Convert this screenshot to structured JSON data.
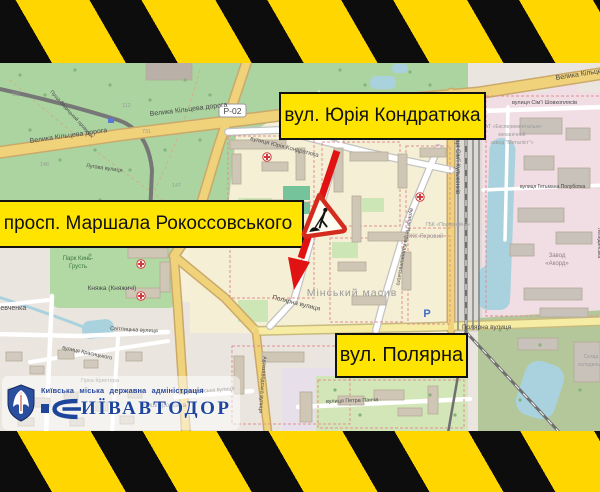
{
  "annotations": {
    "street_top": "вул. Юрія Кондратюка",
    "street_left": "просп. Маршала Рокоссовського",
    "street_bottom": "вул. Полярна"
  },
  "logo": {
    "authority": "Київська міська державна адміністрація",
    "brand": "ИЇВАВТОДОР"
  },
  "map": {
    "ring_road": "Велика Кільцева дорога",
    "ring_road_ref": "Р-02",
    "kondratyuka_st": "вулиця Юрія Кондратюка",
    "kulzhenkiv_st": "вулиця Сім'ї Кульженків",
    "shovkopliasiv_st": "вулиця Сім'ї Шовкоплясів",
    "kalnyshevskoho_st": "вулиця Петра Калнишевського",
    "poliarna_st": "Полярна вулиця",
    "petra_pancha_st": "вулиця Петра Панча",
    "berestiiska_st": "Берестейська вулиця",
    "avtozavodska_st": "Автозаводська вулиця",
    "svitlytska_st": "Світлицька вулиця",
    "krasytskoho_st": "вулиця Красицького",
    "luhova_st": "Лугова вулиця",
    "pushcha_lane": "Пуща-Водицький провулок",
    "hetmana_st": "вулиця Гетьмана Полуботка",
    "vyshhorodska": "Вишгородська",
    "lebedynska": "Лебединська",
    "district": "Мінський масив",
    "zhk_yakhrovyi": "ЖК Яхровий",
    "hbk_poliarnyi": "ГБК «Полярний-7»",
    "zavod_l1": "Завод",
    "zavod_l2": "«Акорд»",
    "pat_l1": "ПАТ «Експериментально-",
    "pat_l2": "механічний",
    "pat_l3": "завод \"Металіст\"»",
    "park_l1": "Парк Кинь-",
    "park_l2": "Грусть",
    "kniazha": "Княжа (Княжичі)",
    "shevchenka": "Шевченка",
    "krystera": "Гірка Кристера",
    "sklad_l1": "Склад",
    "sklad_l2": "холодильн.",
    "parking": "P",
    "parcels": [
      "111",
      "112",
      "731",
      "146",
      "147"
    ]
  },
  "colors": {
    "annotation_bg": "#ffe400",
    "annotation_border": "#111111",
    "tape_yellow": "#ffd600",
    "tape_black": "#0d0d0d",
    "arrow_red": "#e11212",
    "sign_border_red": "#d42b1e",
    "logo_blue": "#1d459c",
    "water": "#a9d2de",
    "forest_green": "#abd4a0",
    "industrial_pink": "#f1dde4",
    "road_yellow": "#f0d27b"
  }
}
